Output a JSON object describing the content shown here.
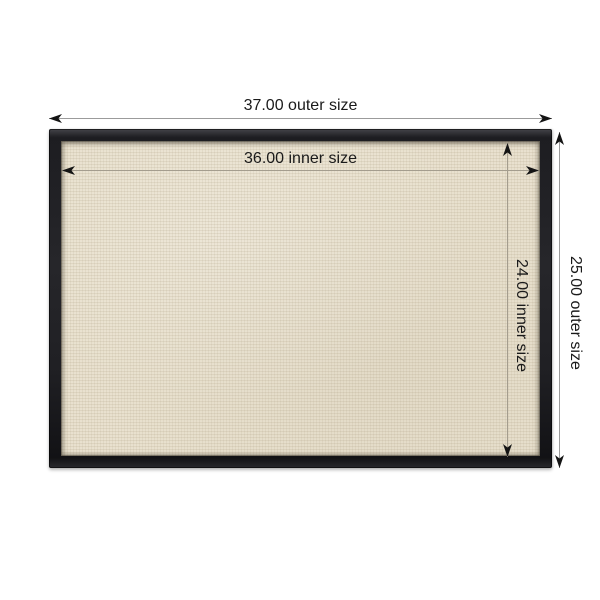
{
  "diagram": {
    "kind": "product-dimension-diagram",
    "subject": "black rectangular frame with natural linen interior",
    "background_color": "#ffffff",
    "frame_color": "#222226",
    "canvas_color": "#e8e0cd",
    "dimension_line_color": "#9b9b9b",
    "arrow_color": "#141414",
    "text_color": "#1a1a1a"
  },
  "dimensions": {
    "outer_width": {
      "label": "37.00 outer size",
      "value": "37.00",
      "kind": "outer width"
    },
    "inner_width": {
      "label": "36.00 inner size",
      "value": "36.00",
      "kind": "inner width"
    },
    "inner_height": {
      "label": "24.00 inner size",
      "value": "24.00",
      "kind": "inner height"
    },
    "outer_height": {
      "label": "25.00 outer size",
      "value": "25.00",
      "kind": "outer height"
    }
  }
}
